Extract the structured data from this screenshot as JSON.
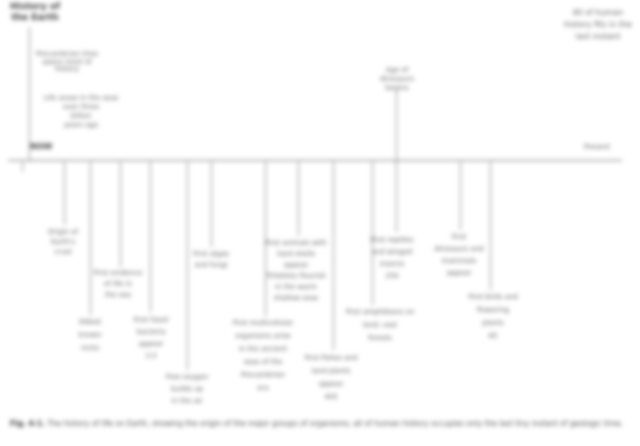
{
  "figure_type": "history-of-earth-timeline",
  "title": {
    "lines": [
      "History of",
      "the Earth"
    ]
  },
  "intro1": {
    "lines": [
      "Precambrian time",
      "spans most of",
      "history"
    ]
  },
  "intro2": {
    "lines": [
      "Life arose in the seas",
      "over three",
      "billion",
      "years ago"
    ]
  },
  "axis": {
    "start_label": "NOW",
    "end_label": "Present",
    "tick": ""
  },
  "marker": {
    "lines": [
      "Age of",
      "dinosaurs",
      "begins"
    ]
  },
  "top_right": {
    "lines": [
      "All of human",
      "history fits in the",
      "last instant"
    ]
  },
  "labels": [
    {
      "lines": [
        "Origin of",
        "Earth's",
        "crust"
      ]
    },
    {
      "lines": [
        "Oldest",
        "known",
        "rocks"
      ]
    },
    {
      "lines": [
        "First evidence",
        "of life in",
        "the sea"
      ]
    },
    {
      "lines": [
        "First fossil",
        "bacteria",
        "appear",
        "3.5"
      ]
    },
    {
      "lines": [
        "Free oxygen",
        "builds up",
        "in the air"
      ]
    },
    {
      "lines": [
        "First algae",
        "and fungi"
      ]
    },
    {
      "lines": [
        "First multicellular",
        "organisms arise",
        "in the ancient",
        "seas of the",
        "Precambrian",
        "era"
      ]
    },
    {
      "lines": [
        "First animals with",
        "hard shells",
        "appear",
        "Trilobites flourish",
        "in the warm",
        "shallow seas"
      ]
    },
    {
      "lines": [
        "First fishes and",
        "land plants",
        "appear",
        "405"
      ]
    },
    {
      "lines": [
        "First amphibians on",
        "land; vast",
        "forests"
      ]
    },
    {
      "lines": [
        "First reptiles",
        "and winged",
        "insects",
        "250"
      ]
    },
    {
      "lines": [
        "First",
        "dinosaurs and",
        "mammals",
        "appear"
      ]
    },
    {
      "lines": [
        "First birds and",
        "flowering",
        "plants",
        "65"
      ]
    }
  ],
  "caption": {
    "prefix": "Fig. 4-1.",
    "text": " The history of life on Earth, showing the origin of the major groups of organisms; all of human history occupies only the last tiny instant of geologic time."
  },
  "colors": {
    "ink": "#5f5f5f",
    "dark_ink": "#3a3a3a",
    "line": "#8a8a8a",
    "timeline": "#6a6a6a"
  }
}
